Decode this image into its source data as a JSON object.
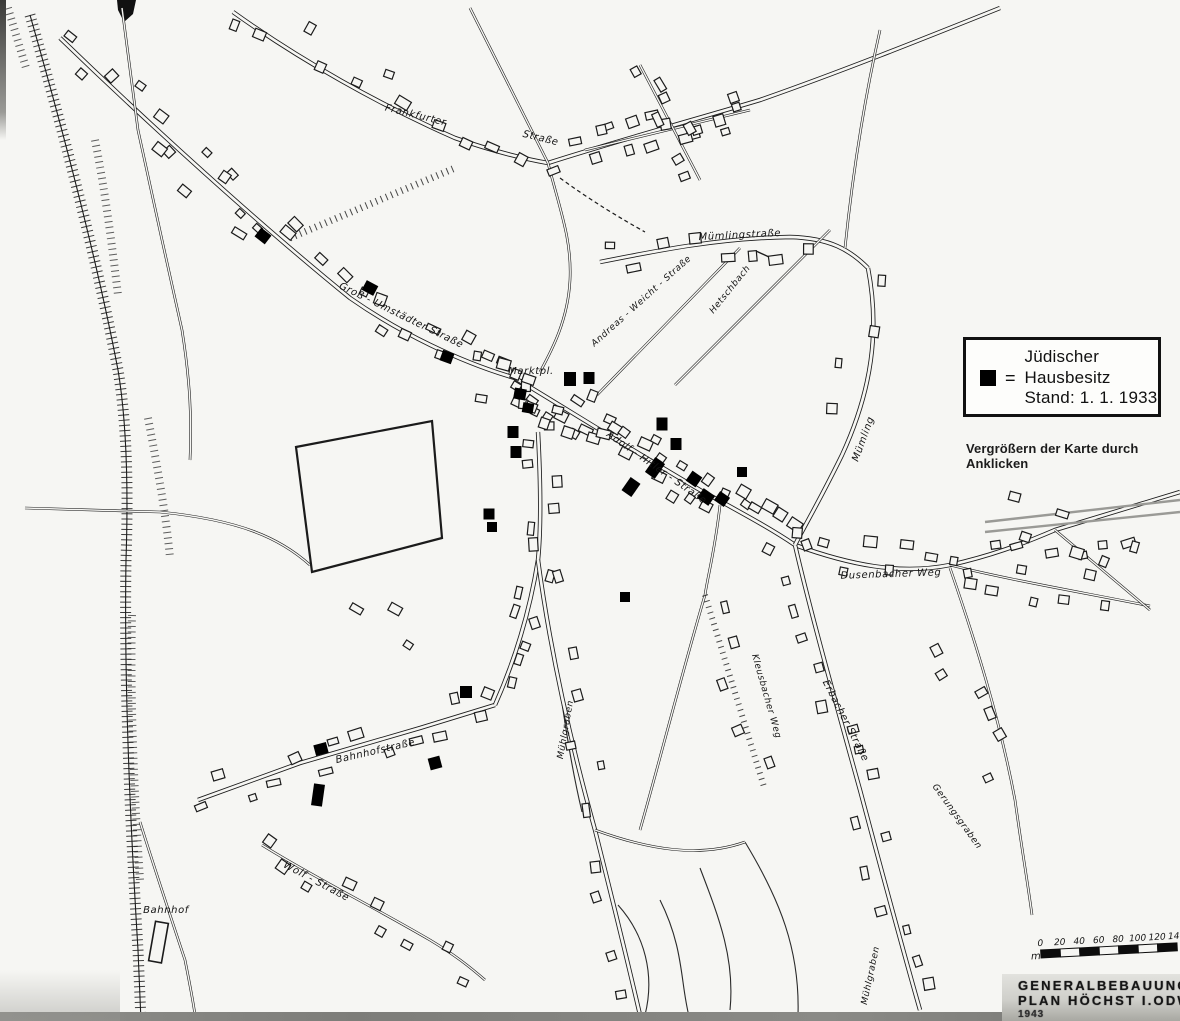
{
  "map": {
    "colors": {
      "ink": "#1b1b1b",
      "paper": "#f6f6f3",
      "marker": "#000000",
      "rail_gray": "#9a9a96"
    },
    "legend": {
      "symbol": "black-square",
      "equals": "=",
      "lines": [
        "Jüdischer",
        "Hausbesitz",
        "Stand: 1. 1. 1933"
      ]
    },
    "caption": "Vergrößern der Karte durch Anklicken",
    "title_block": {
      "line1": "GENERALBEBAUUNGS-",
      "line2": "PLAN    HÖCHST   I.ODW",
      "line3": "1943"
    },
    "scale": {
      "unit": "m",
      "ticks": [
        "0",
        "20",
        "40",
        "60",
        "80",
        "100",
        "120",
        "140"
      ]
    },
    "street_labels": [
      {
        "text": "Frankfurter",
        "x": 415,
        "y": 118,
        "rot": 14,
        "size": 10
      },
      {
        "text": "Straße",
        "x": 540,
        "y": 141,
        "rot": 14,
        "size": 10
      },
      {
        "text": "Groß - Umstädter   Straße",
        "x": 400,
        "y": 318,
        "rot": 26,
        "size": 10
      },
      {
        "text": "Mümlingstraße",
        "x": 740,
        "y": 238,
        "rot": -3,
        "size": 10
      },
      {
        "text": "Andreas - Weicht - Straße",
        "x": 643,
        "y": 303,
        "rot": -42,
        "size": 9
      },
      {
        "text": "Hetschbach",
        "x": 732,
        "y": 291,
        "rot": -51,
        "size": 9
      },
      {
        "text": "Marktpl.",
        "x": 531,
        "y": 374,
        "rot": 0,
        "size": 10
      },
      {
        "text": "Adolf - Hitler - Straße",
        "x": 655,
        "y": 470,
        "rot": 35,
        "size": 10
      },
      {
        "text": "Mümling",
        "x": 866,
        "y": 440,
        "rot": -70,
        "size": 10
      },
      {
        "text": "Dusenbacher  Weg",
        "x": 891,
        "y": 577,
        "rot": -2,
        "size": 10
      },
      {
        "text": "Erbacher  Straße",
        "x": 843,
        "y": 722,
        "rot": 63,
        "size": 10
      },
      {
        "text": "Bahnhofstraße",
        "x": 376,
        "y": 754,
        "rot": -13,
        "size": 10
      },
      {
        "text": "Wolf - Straße",
        "x": 315,
        "y": 884,
        "rot": 28,
        "size": 10
      },
      {
        "text": "Bahnhof",
        "x": 166,
        "y": 913,
        "rot": 0,
        "size": 10
      },
      {
        "text": "Mühlgraben",
        "x": 568,
        "y": 730,
        "rot": -80,
        "size": 9
      },
      {
        "text": "Mühlgraben",
        "x": 873,
        "y": 976,
        "rot": -78,
        "size": 9
      },
      {
        "text": "Kleusbacher Weg",
        "x": 764,
        "y": 697,
        "rot": 74,
        "size": 9
      },
      {
        "text": "Gerungsgraben",
        "x": 955,
        "y": 818,
        "rot": 54,
        "size": 9
      }
    ],
    "jewish_houses": [
      {
        "x": 263,
        "y": 236,
        "w": 13,
        "h": 11,
        "rot": 38
      },
      {
        "x": 370,
        "y": 288,
        "w": 13,
        "h": 11,
        "rot": 28
      },
      {
        "x": 447,
        "y": 357,
        "w": 12,
        "h": 11,
        "rot": 20
      },
      {
        "x": 520,
        "y": 394,
        "w": 12,
        "h": 11,
        "rot": 10
      },
      {
        "x": 528,
        "y": 408,
        "w": 11,
        "h": 10,
        "rot": 10
      },
      {
        "x": 570,
        "y": 379,
        "w": 12,
        "h": 14,
        "rot": 0
      },
      {
        "x": 589,
        "y": 378,
        "w": 11,
        "h": 12,
        "rot": 0
      },
      {
        "x": 513,
        "y": 432,
        "w": 11,
        "h": 12,
        "rot": 0
      },
      {
        "x": 516,
        "y": 452,
        "w": 11,
        "h": 12,
        "rot": 0
      },
      {
        "x": 489,
        "y": 514,
        "w": 11,
        "h": 11,
        "rot": 0
      },
      {
        "x": 492,
        "y": 527,
        "w": 10,
        "h": 10,
        "rot": 0
      },
      {
        "x": 631,
        "y": 487,
        "w": 12,
        "h": 16,
        "rot": 35
      },
      {
        "x": 655,
        "y": 468,
        "w": 12,
        "h": 18,
        "rot": 35
      },
      {
        "x": 662,
        "y": 424,
        "w": 11,
        "h": 13,
        "rot": 0
      },
      {
        "x": 676,
        "y": 444,
        "w": 11,
        "h": 12,
        "rot": 0
      },
      {
        "x": 694,
        "y": 479,
        "w": 12,
        "h": 12,
        "rot": 35
      },
      {
        "x": 706,
        "y": 497,
        "w": 14,
        "h": 12,
        "rot": 35
      },
      {
        "x": 722,
        "y": 499,
        "w": 12,
        "h": 11,
        "rot": 35
      },
      {
        "x": 742,
        "y": 472,
        "w": 10,
        "h": 10,
        "rot": 0
      },
      {
        "x": 625,
        "y": 597,
        "w": 10,
        "h": 10,
        "rot": 0
      },
      {
        "x": 466,
        "y": 692,
        "w": 12,
        "h": 12,
        "rot": 0
      },
      {
        "x": 321,
        "y": 749,
        "w": 13,
        "h": 11,
        "rot": -15
      },
      {
        "x": 435,
        "y": 763,
        "w": 12,
        "h": 12,
        "rot": -15
      },
      {
        "x": 318,
        "y": 795,
        "w": 11,
        "h": 22,
        "rot": 8
      }
    ]
  }
}
